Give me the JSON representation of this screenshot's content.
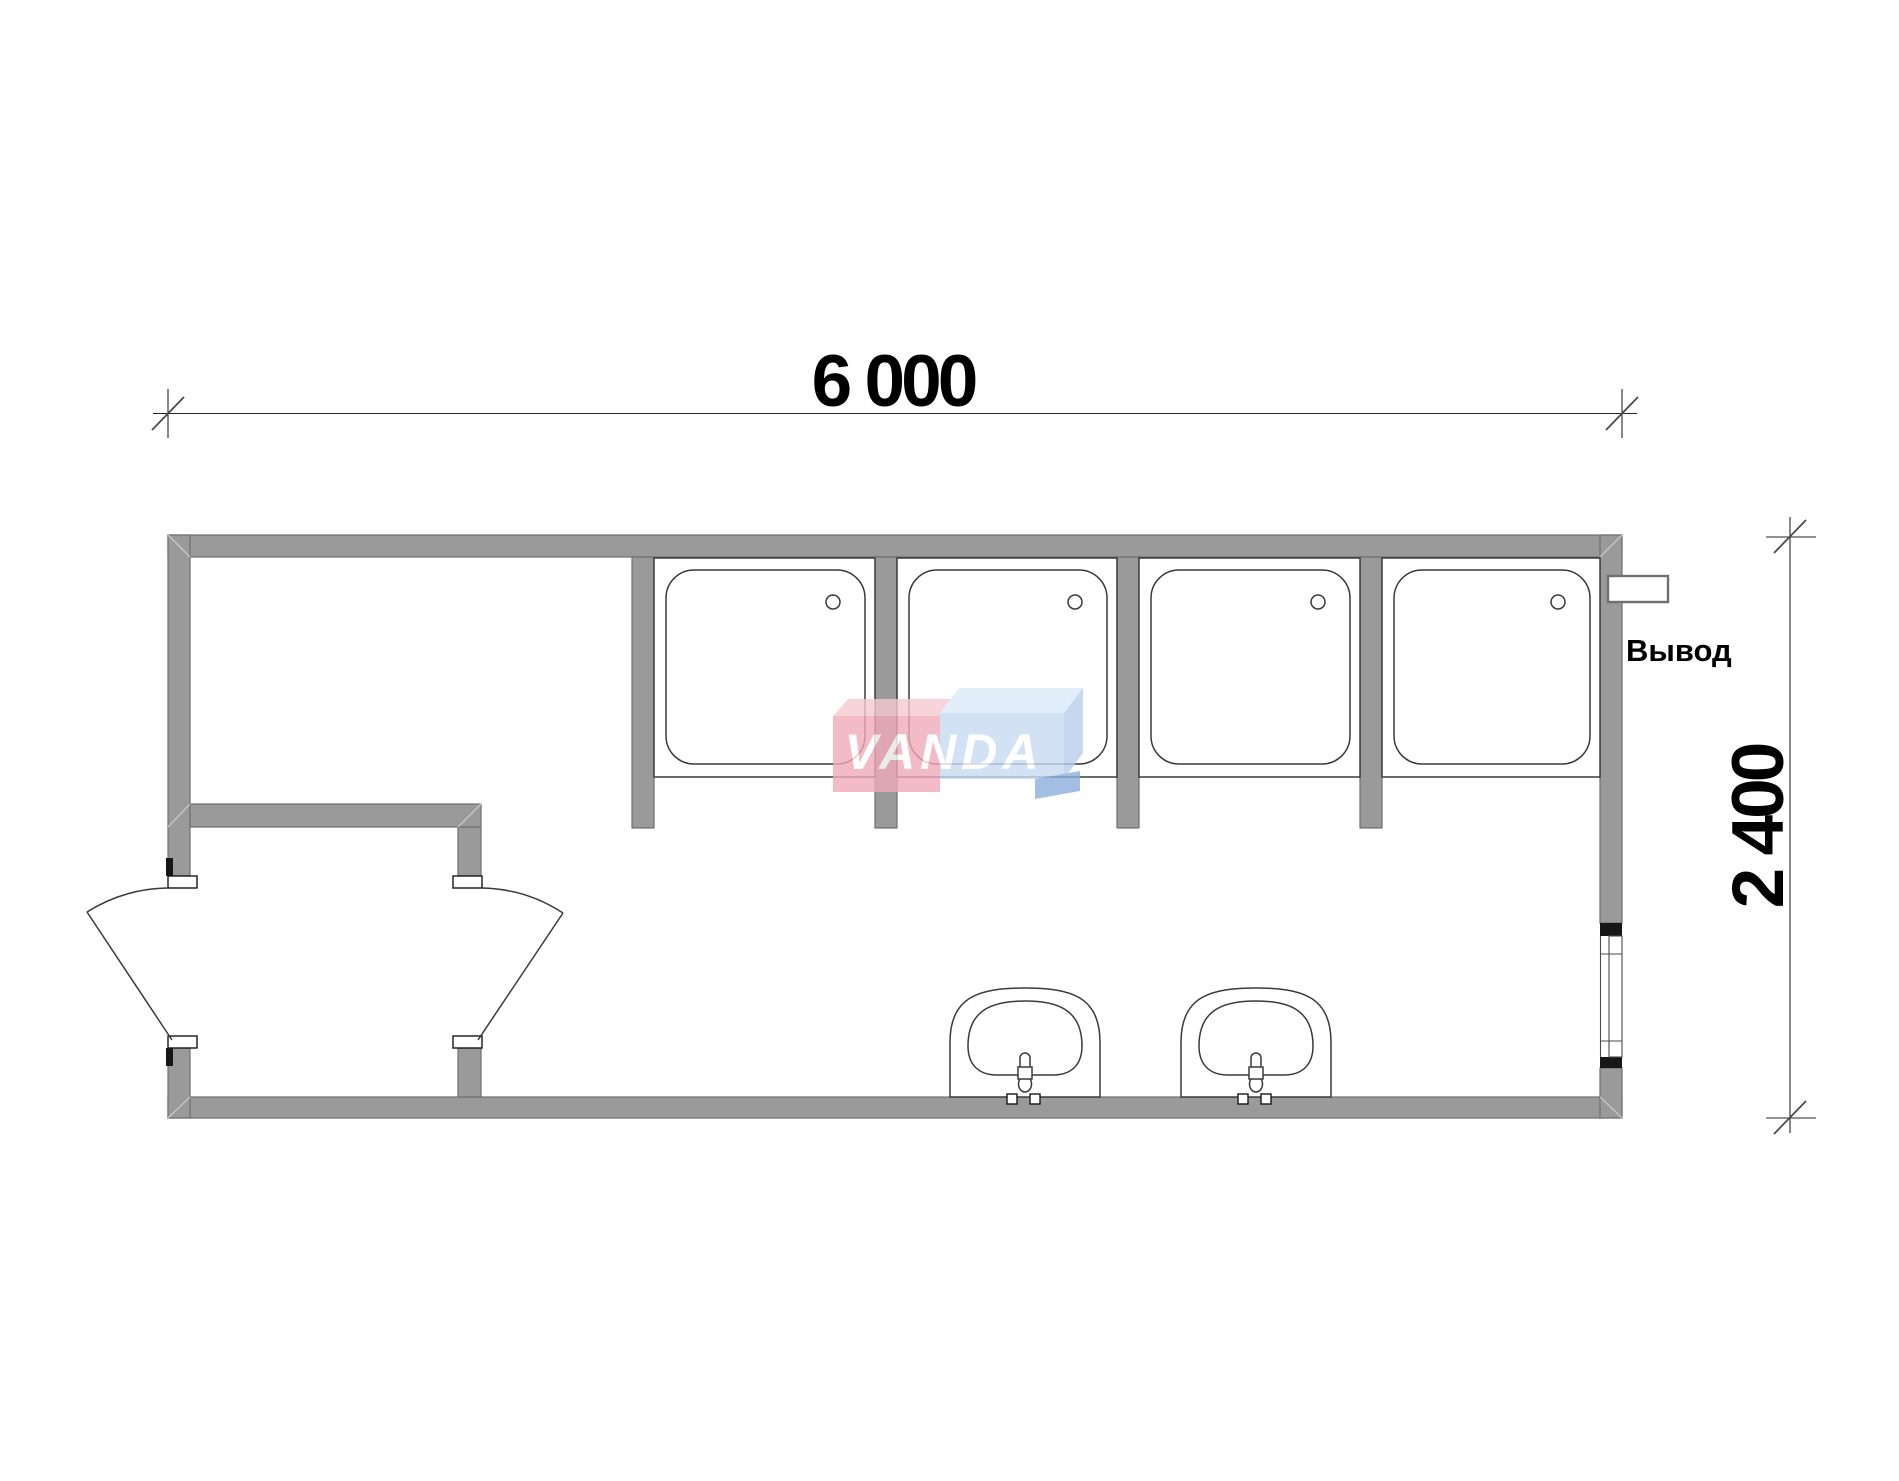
{
  "dimensions": {
    "width_label": "6 000",
    "height_label": "2 400"
  },
  "labels": {
    "outlet": "Вывод"
  },
  "watermark": {
    "text": "VANDA"
  },
  "fixtures": {
    "shower_stalls": 4,
    "wash_basins": 2,
    "doors": 2,
    "windows": 1
  },
  "colors": {
    "wall": "#9a9a9a",
    "line": "#3a3a3a",
    "watermark_pink": "#f0abba",
    "watermark_pink_light": "#f6c9d2",
    "watermark_blue": "#c8dcf2",
    "watermark_blue_light": "#dceaf8",
    "watermark_blue_side": "#b8cfec",
    "watermark_blue_dark": "#8cb0dd",
    "watermark_text": "#ffffff"
  }
}
